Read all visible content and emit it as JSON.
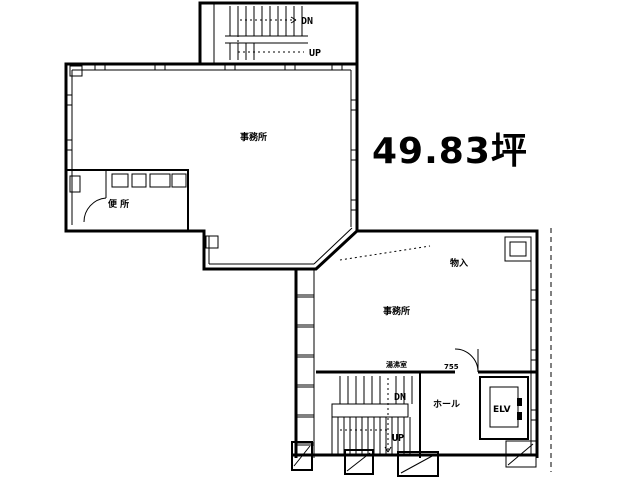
{
  "area_label": "49.83坪",
  "rooms": {
    "office_upper": "事務所",
    "office_lower": "事務所",
    "toilet": "便 所",
    "storage": "物入",
    "kitchenette": "湯沸室",
    "hall": "ホール",
    "elevator": "ELV",
    "dimension": "755"
  },
  "stairs_top": {
    "down": "DN",
    "up": "UP"
  },
  "stairs_bottom": {
    "down": "DN",
    "up": "UP"
  },
  "colors": {
    "line": "#000000",
    "background": "#ffffff"
  }
}
